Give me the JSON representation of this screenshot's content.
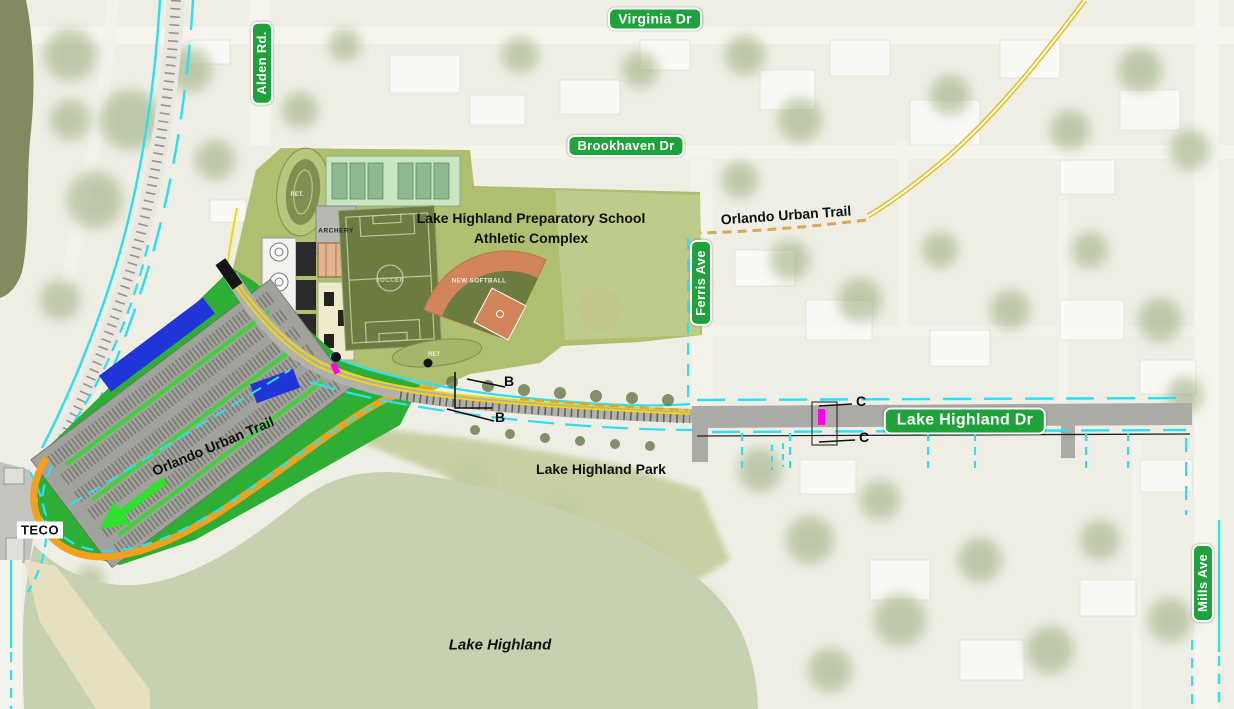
{
  "map": {
    "street_signs": {
      "virginia_dr": "Virginia Dr",
      "alden_rd": "Alden Rd.",
      "brookhaven_dr": "Brookhaven Dr",
      "ferris_ave": "Ferris Ave",
      "lake_highland_dr": "Lake Highland Dr",
      "mills_ave": "Mills Ave"
    },
    "annotations": {
      "complex_title_line1": "Lake Highland Preparatory School",
      "complex_title_line2": "Athletic Complex",
      "orlando_urban_trail_east": "Orlando Urban Trail",
      "orlando_urban_trail_west": "Orlando Urban Trail",
      "lake_highland_park": "Lake Highland Park",
      "lake_highland": "Lake Highland",
      "teco": "TECO",
      "archery": "ARCHERY",
      "soccer": "SOCCER",
      "new_softball": "NEW SOFTBALL",
      "ret_track": "RET.",
      "ret_pond": "RET",
      "section_marker_b": "B",
      "section_marker_c": "C"
    },
    "colors": {
      "sign_green": "#1fa23c",
      "plan_green": "#2fae36",
      "trail_orange": "#f2a01e",
      "bike_cyan": "#2ae0f2",
      "line_yellow": "#f5d800",
      "field_olive": "#6d7d42",
      "clay_orange": "#d2845a",
      "canopy_blue": "#1f35d8",
      "marker_magenta": "#ff00ee",
      "lake_sage": "#c6d1b2"
    }
  }
}
